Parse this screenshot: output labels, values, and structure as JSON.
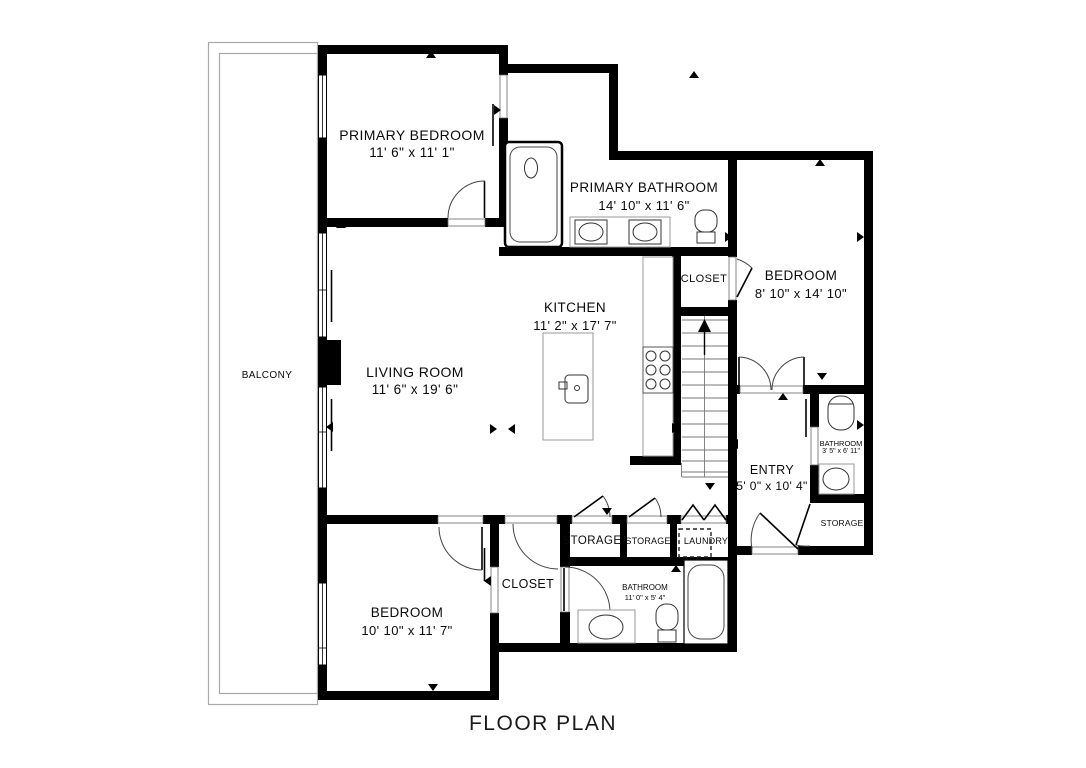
{
  "title": "FLOOR PLAN",
  "rooms": {
    "primary_bedroom": {
      "name": "PRIMARY BEDROOM",
      "dims": "11' 6\" x 11' 1\""
    },
    "primary_bathroom": {
      "name": "PRIMARY BATHROOM",
      "dims": "14' 10\" x 11' 6\""
    },
    "bedroom_upper": {
      "name": "BEDROOM",
      "dims": "8' 10\" x 14' 10\""
    },
    "closet_upper": {
      "name": "CLOSET"
    },
    "kitchen": {
      "name": "KITCHEN",
      "dims": "11' 2\" x 17' 7\""
    },
    "living_room": {
      "name": "LIVING ROOM",
      "dims": "11' 6\" x 19' 6\""
    },
    "balcony": {
      "name": "BALCONY"
    },
    "entry": {
      "name": "ENTRY",
      "dims": "5' 0\" x 10' 4\""
    },
    "bathroom_right": {
      "name": "BATHROOM",
      "dims": "3' 5\" x 6' 11\""
    },
    "storage_right": {
      "name": "STORAGE"
    },
    "storage_1": {
      "name": "STORAGE"
    },
    "storage_2": {
      "name": "STORAGE"
    },
    "laundry": {
      "name": "LAUNDRY"
    },
    "closet_lower": {
      "name": "CLOSET"
    },
    "bathroom_lower": {
      "name": "BATHROOM",
      "dims": "11' 0\" x 5' 4\""
    },
    "bedroom_lower": {
      "name": "BEDROOM",
      "dims": "10' 10\" x 11' 7\""
    }
  }
}
